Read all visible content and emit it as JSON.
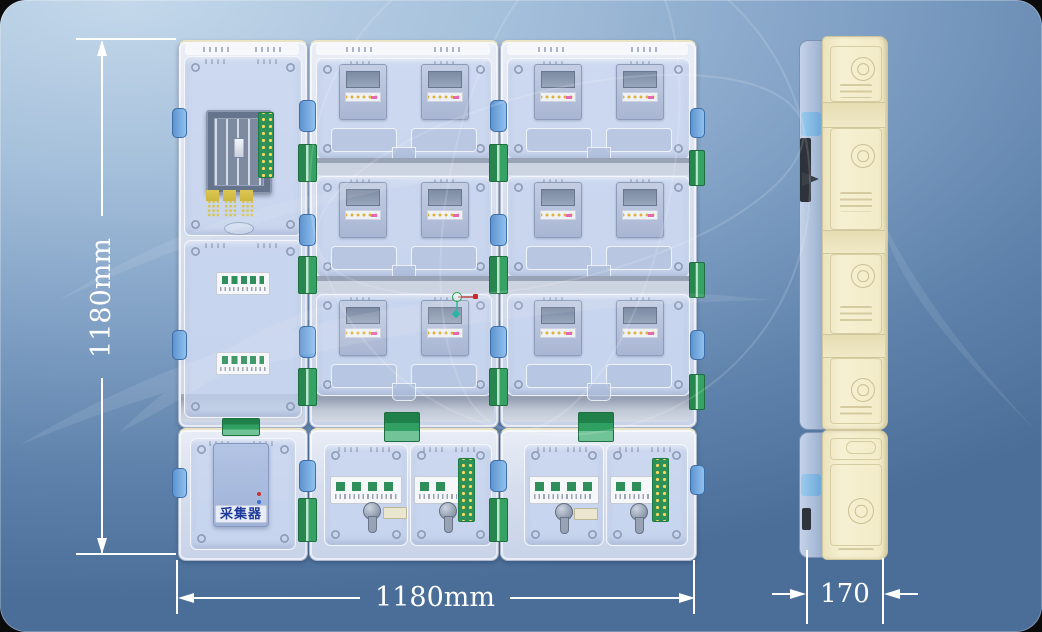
{
  "dimensions": {
    "height_label": "1180mm",
    "width_label": "1180mm",
    "depth_label": "170"
  },
  "front_view": {
    "collector_label": "采集器",
    "meter_module_rows": 3,
    "meter_module_columns": 2,
    "meters_per_module": 2,
    "total_meters": 12
  },
  "colors": {
    "background_top": "#c4d8ea",
    "background_bottom": "#4b6e98",
    "cabinet_body": "#d6deee",
    "window_tint": "#c5d4ee",
    "hinge_green": "#2e9158",
    "terminal_dot_yellow": "#ffd95e",
    "side_body_cream": "#f3ecc9",
    "collector_label_blue": "#1e3a9a",
    "dimension_text": "#ffffff"
  }
}
